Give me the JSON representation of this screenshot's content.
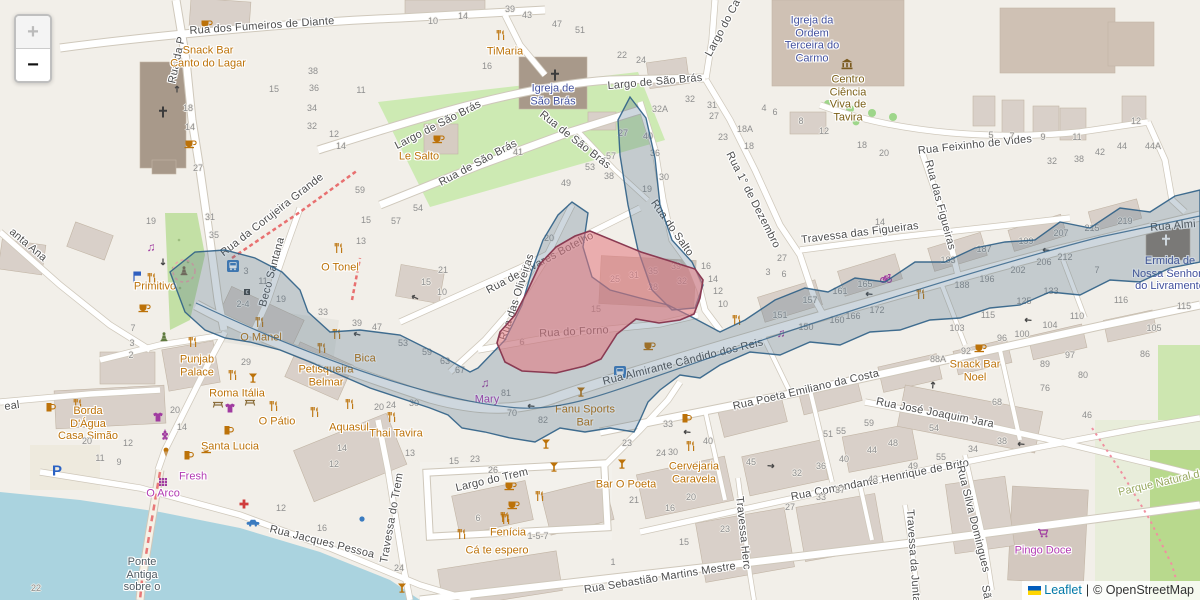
{
  "controls": {
    "zoom_in": "+",
    "zoom_out": "−"
  },
  "attribution": {
    "flag": "ukraine-flag",
    "leaflet": "Leaflet",
    "divider": "|",
    "copyright": "© OpenStreetMap"
  },
  "overlay_colors": {
    "district_fill": "#4a6c84",
    "district_stroke": "#2e5f86",
    "highlight_fill": "#e4777d",
    "highlight_stroke": "#8a3a52"
  },
  "icon_colors": {
    "amenity": "#bc7209",
    "shop": "#a03ba0",
    "transport": "#3a7bc0",
    "tourism": "#7a5a1e",
    "health": "#d03c3c"
  },
  "streets": [
    "Rua dos Fumeiros de Diante",
    "Rua da P",
    "Largo de São Brás",
    "Largo de São Brás",
    "Rua de São Brás",
    "Rua de São Brás",
    "Rua Feixinho de Vides",
    "Largo do Ca",
    "Rua 1° de Dezembro",
    "Rua do Salto",
    "Travessa das Figueiras",
    "Rua das Figueiras",
    "Rua de Álvares Botelho",
    "Rua das Oliveiras",
    "Rua do Forno",
    "Rua Almirante Cândido dos Reis",
    "Rua Almi",
    "Rua da Corujeira Grande",
    "Beco Santana",
    "anta Ana",
    "Rua Poeta Emiliano da Costa",
    "Rua José Joaquim Jara",
    "Rua Comandante Henrique de Brito",
    "Rua Sebastião Martins Mestre",
    "Rua Jacques Pessoa",
    "Largo do Trem",
    "Travessa do Trem",
    "Travessa Herc",
    "Travessa da Junta",
    "Rua Silva Domingues",
    "eal",
    "Sã"
  ],
  "pois": [
    "Snack Bar Canto do Lagar",
    "TiMaria",
    "Igreja de São Brás",
    "Le Salto",
    "Igreja da Ordem Terceira do Carmo",
    "Centro Ciência Viva de Tavira",
    "Ermida de Nossa Senhora do Livramento",
    "O Tonel",
    "Primitivo",
    "O Manel",
    "Punjab Palace",
    "Roma Itália",
    "Petisqueira Belmar",
    "Bica",
    "Mary",
    "Fanu Sports Bar",
    "Borda D'Água Casa Simão",
    "O Pátio",
    "Aquasul",
    "Thai Tavira",
    "Santa Lucia",
    "Fresh",
    "O Arco",
    "Cá te espero",
    "Fenícia",
    "Cervejaria Caravela",
    "Bar O Poeta",
    "Snack Bar Noel",
    "Pingo Doce",
    "Parque Natural da",
    "Ponte Antiga sobre o"
  ],
  "house_numbers": [
    {
      "t": "18",
      "x": 188,
      "y": 108
    },
    {
      "t": "14",
      "x": 190,
      "y": 127
    },
    {
      "t": "27",
      "x": 198,
      "y": 168
    },
    {
      "t": "15",
      "x": 274,
      "y": 89
    },
    {
      "t": "10",
      "x": 433,
      "y": 21
    },
    {
      "t": "14",
      "x": 463,
      "y": 16
    },
    {
      "t": "39",
      "x": 510,
      "y": 9
    },
    {
      "t": "43",
      "x": 527,
      "y": 15
    },
    {
      "t": "47",
      "x": 557,
      "y": 24
    },
    {
      "t": "51",
      "x": 580,
      "y": 30
    },
    {
      "t": "38",
      "x": 313,
      "y": 71
    },
    {
      "t": "36",
      "x": 314,
      "y": 88
    },
    {
      "t": "34",
      "x": 312,
      "y": 108
    },
    {
      "t": "32",
      "x": 312,
      "y": 126
    },
    {
      "t": "12",
      "x": 334,
      "y": 134
    },
    {
      "t": "14",
      "x": 341,
      "y": 146
    },
    {
      "t": "11",
      "x": 361,
      "y": 90
    },
    {
      "t": "16",
      "x": 487,
      "y": 66
    },
    {
      "t": "59",
      "x": 360,
      "y": 190
    },
    {
      "t": "41",
      "x": 518,
      "y": 152
    },
    {
      "t": "53",
      "x": 590,
      "y": 167
    },
    {
      "t": "49",
      "x": 566,
      "y": 183
    },
    {
      "t": "22",
      "x": 622,
      "y": 55
    },
    {
      "t": "24",
      "x": 641,
      "y": 60
    },
    {
      "t": "32",
      "x": 690,
      "y": 99
    },
    {
      "t": "32A",
      "x": 660,
      "y": 109
    },
    {
      "t": "31",
      "x": 712,
      "y": 105
    },
    {
      "t": "27",
      "x": 714,
      "y": 116
    },
    {
      "t": "18A",
      "x": 745,
      "y": 129
    },
    {
      "t": "23",
      "x": 723,
      "y": 137
    },
    {
      "t": "18",
      "x": 749,
      "y": 146
    },
    {
      "t": "4",
      "x": 764,
      "y": 108
    },
    {
      "t": "6",
      "x": 775,
      "y": 112
    },
    {
      "t": "8",
      "x": 801,
      "y": 121
    },
    {
      "t": "12",
      "x": 824,
      "y": 131
    },
    {
      "t": "18",
      "x": 862,
      "y": 145
    },
    {
      "t": "20",
      "x": 884,
      "y": 153
    },
    {
      "t": "27",
      "x": 623,
      "y": 133
    },
    {
      "t": "40",
      "x": 648,
      "y": 136
    },
    {
      "t": "57",
      "x": 611,
      "y": 156
    },
    {
      "t": "36",
      "x": 655,
      "y": 153
    },
    {
      "t": "38",
      "x": 609,
      "y": 176
    },
    {
      "t": "30",
      "x": 664,
      "y": 177
    },
    {
      "t": "19",
      "x": 647,
      "y": 189
    },
    {
      "t": "5",
      "x": 991,
      "y": 135
    },
    {
      "t": "7",
      "x": 1012,
      "y": 136
    },
    {
      "t": "9",
      "x": 1043,
      "y": 137
    },
    {
      "t": "11",
      "x": 1077,
      "y": 137
    },
    {
      "t": "12",
      "x": 1136,
      "y": 121
    },
    {
      "t": "44",
      "x": 1122,
      "y": 146
    },
    {
      "t": "44A",
      "x": 1153,
      "y": 146
    },
    {
      "t": "42",
      "x": 1100,
      "y": 152
    },
    {
      "t": "38",
      "x": 1079,
      "y": 159
    },
    {
      "t": "32",
      "x": 1052,
      "y": 161
    },
    {
      "t": "19",
      "x": 151,
      "y": 221
    },
    {
      "t": "31",
      "x": 210,
      "y": 217
    },
    {
      "t": "35",
      "x": 214,
      "y": 235
    },
    {
      "t": "3",
      "x": 246,
      "y": 271
    },
    {
      "t": "11",
      "x": 263,
      "y": 281
    },
    {
      "t": "19",
      "x": 281,
      "y": 299
    },
    {
      "t": "2-4",
      "x": 243,
      "y": 304
    },
    {
      "t": "29",
      "x": 246,
      "y": 362
    },
    {
      "t": "22",
      "x": 36,
      "y": 588
    },
    {
      "t": "7",
      "x": 133,
      "y": 328
    },
    {
      "t": "3",
      "x": 132,
      "y": 343
    },
    {
      "t": "2",
      "x": 131,
      "y": 355
    },
    {
      "t": "54",
      "x": 418,
      "y": 208
    },
    {
      "t": "57",
      "x": 396,
      "y": 221
    },
    {
      "t": "15",
      "x": 366,
      "y": 220
    },
    {
      "t": "13",
      "x": 361,
      "y": 241
    },
    {
      "t": "21",
      "x": 443,
      "y": 270
    },
    {
      "t": "15",
      "x": 426,
      "y": 282
    },
    {
      "t": "10",
      "x": 442,
      "y": 292
    },
    {
      "t": "33",
      "x": 323,
      "y": 312
    },
    {
      "t": "39",
      "x": 357,
      "y": 323
    },
    {
      "t": "47",
      "x": 377,
      "y": 327
    },
    {
      "t": "53",
      "x": 403,
      "y": 343
    },
    {
      "t": "59",
      "x": 427,
      "y": 352
    },
    {
      "t": "63",
      "x": 445,
      "y": 361
    },
    {
      "t": "67",
      "x": 460,
      "y": 370
    },
    {
      "t": "81",
      "x": 506,
      "y": 393
    },
    {
      "t": "70",
      "x": 512,
      "y": 413
    },
    {
      "t": "82",
      "x": 543,
      "y": 420
    },
    {
      "t": "25",
      "x": 615,
      "y": 279
    },
    {
      "t": "31",
      "x": 634,
      "y": 275
    },
    {
      "t": "35",
      "x": 653,
      "y": 271
    },
    {
      "t": "39",
      "x": 676,
      "y": 266
    },
    {
      "t": "28",
      "x": 653,
      "y": 287
    },
    {
      "t": "32",
      "x": 682,
      "y": 281
    },
    {
      "t": "15",
      "x": 596,
      "y": 309
    },
    {
      "t": "6",
      "x": 522,
      "y": 342
    },
    {
      "t": "20",
      "x": 549,
      "y": 238
    },
    {
      "t": "16",
      "x": 706,
      "y": 266
    },
    {
      "t": "14",
      "x": 713,
      "y": 279
    },
    {
      "t": "12",
      "x": 718,
      "y": 291
    },
    {
      "t": "10",
      "x": 723,
      "y": 304
    },
    {
      "t": "27",
      "x": 782,
      "y": 258
    },
    {
      "t": "3",
      "x": 768,
      "y": 272
    },
    {
      "t": "6",
      "x": 784,
      "y": 274
    },
    {
      "t": "14",
      "x": 880,
      "y": 222
    },
    {
      "t": "151",
      "x": 780,
      "y": 315
    },
    {
      "t": "157",
      "x": 810,
      "y": 300
    },
    {
      "t": "161",
      "x": 840,
      "y": 291
    },
    {
      "t": "165",
      "x": 865,
      "y": 284
    },
    {
      "t": "150",
      "x": 806,
      "y": 327
    },
    {
      "t": "160",
      "x": 837,
      "y": 320
    },
    {
      "t": "166",
      "x": 853,
      "y": 316
    },
    {
      "t": "172",
      "x": 877,
      "y": 310
    },
    {
      "t": "187",
      "x": 984,
      "y": 249
    },
    {
      "t": "199",
      "x": 1026,
      "y": 241
    },
    {
      "t": "207",
      "x": 1061,
      "y": 233
    },
    {
      "t": "215",
      "x": 1092,
      "y": 228
    },
    {
      "t": "219",
      "x": 1125,
      "y": 221
    },
    {
      "t": "183",
      "x": 948,
      "y": 260
    },
    {
      "t": "202",
      "x": 1018,
      "y": 270
    },
    {
      "t": "206",
      "x": 1044,
      "y": 262
    },
    {
      "t": "212",
      "x": 1065,
      "y": 257
    },
    {
      "t": "196",
      "x": 987,
      "y": 279
    },
    {
      "t": "188",
      "x": 962,
      "y": 285
    },
    {
      "t": "133",
      "x": 1051,
      "y": 291
    },
    {
      "t": "125",
      "x": 1024,
      "y": 301
    },
    {
      "t": "115",
      "x": 988,
      "y": 315
    },
    {
      "t": "103",
      "x": 957,
      "y": 328
    },
    {
      "t": "96",
      "x": 1002,
      "y": 338
    },
    {
      "t": "100",
      "x": 1022,
      "y": 334
    },
    {
      "t": "104",
      "x": 1050,
      "y": 325
    },
    {
      "t": "110",
      "x": 1077,
      "y": 316
    },
    {
      "t": "92",
      "x": 966,
      "y": 351
    },
    {
      "t": "88A",
      "x": 938,
      "y": 359
    },
    {
      "t": "89",
      "x": 1045,
      "y": 364
    },
    {
      "t": "97",
      "x": 1070,
      "y": 355
    },
    {
      "t": "80",
      "x": 1083,
      "y": 375
    },
    {
      "t": "76",
      "x": 1045,
      "y": 388
    },
    {
      "t": "105",
      "x": 1154,
      "y": 328
    },
    {
      "t": "115",
      "x": 1184,
      "y": 306
    },
    {
      "t": "116",
      "x": 1121,
      "y": 300
    },
    {
      "t": "86",
      "x": 1145,
      "y": 354
    },
    {
      "t": "7",
      "x": 1097,
      "y": 270
    },
    {
      "t": "20",
      "x": 175,
      "y": 410
    },
    {
      "t": "14",
      "x": 182,
      "y": 427
    },
    {
      "t": "12",
      "x": 128,
      "y": 443
    },
    {
      "t": "20",
      "x": 87,
      "y": 441
    },
    {
      "t": "11",
      "x": 100,
      "y": 458
    },
    {
      "t": "9",
      "x": 119,
      "y": 462
    },
    {
      "t": "12",
      "x": 281,
      "y": 508
    },
    {
      "t": "20",
      "x": 379,
      "y": 407
    },
    {
      "t": "24",
      "x": 391,
      "y": 405
    },
    {
      "t": "30",
      "x": 414,
      "y": 403
    },
    {
      "t": "14",
      "x": 342,
      "y": 448
    },
    {
      "t": "12",
      "x": 334,
      "y": 464
    },
    {
      "t": "13",
      "x": 410,
      "y": 453
    },
    {
      "t": "15",
      "x": 454,
      "y": 461
    },
    {
      "t": "23",
      "x": 475,
      "y": 459
    },
    {
      "t": "26",
      "x": 493,
      "y": 470
    },
    {
      "t": "16",
      "x": 322,
      "y": 528
    },
    {
      "t": "6",
      "x": 478,
      "y": 518
    },
    {
      "t": "24",
      "x": 399,
      "y": 568
    },
    {
      "t": "1-5-7",
      "x": 538,
      "y": 536
    },
    {
      "t": "33",
      "x": 668,
      "y": 424
    },
    {
      "t": "23",
      "x": 627,
      "y": 443
    },
    {
      "t": "24",
      "x": 661,
      "y": 453
    },
    {
      "t": "30",
      "x": 673,
      "y": 452
    },
    {
      "t": "40",
      "x": 708,
      "y": 441
    },
    {
      "t": "45",
      "x": 751,
      "y": 462
    },
    {
      "t": "51",
      "x": 828,
      "y": 434
    },
    {
      "t": "55",
      "x": 841,
      "y": 431
    },
    {
      "t": "59",
      "x": 869,
      "y": 423
    },
    {
      "t": "44",
      "x": 872,
      "y": 450
    },
    {
      "t": "48",
      "x": 893,
      "y": 443
    },
    {
      "t": "40",
      "x": 844,
      "y": 459
    },
    {
      "t": "36",
      "x": 821,
      "y": 466
    },
    {
      "t": "32",
      "x": 797,
      "y": 473
    },
    {
      "t": "27",
      "x": 790,
      "y": 507
    },
    {
      "t": "33",
      "x": 821,
      "y": 497
    },
    {
      "t": "37",
      "x": 840,
      "y": 490
    },
    {
      "t": "43",
      "x": 873,
      "y": 479
    },
    {
      "t": "21",
      "x": 634,
      "y": 500
    },
    {
      "t": "20",
      "x": 691,
      "y": 497
    },
    {
      "t": "16",
      "x": 670,
      "y": 508
    },
    {
      "t": "23",
      "x": 725,
      "y": 529
    },
    {
      "t": "15",
      "x": 684,
      "y": 542
    },
    {
      "t": "1",
      "x": 613,
      "y": 562
    },
    {
      "t": "68",
      "x": 997,
      "y": 402
    },
    {
      "t": "46",
      "x": 1087,
      "y": 415
    },
    {
      "t": "54",
      "x": 934,
      "y": 428
    },
    {
      "t": "38",
      "x": 1002,
      "y": 441
    },
    {
      "t": "34",
      "x": 973,
      "y": 449
    },
    {
      "t": "55",
      "x": 941,
      "y": 457
    },
    {
      "t": "49",
      "x": 913,
      "y": 466
    }
  ],
  "icons": [
    {
      "type": "cafe",
      "x": 206,
      "y": 24
    },
    {
      "type": "cafe",
      "x": 190,
      "y": 144
    },
    {
      "type": "cafe",
      "x": 144,
      "y": 308
    },
    {
      "type": "cafe",
      "x": 438,
      "y": 139
    },
    {
      "type": "cafe",
      "x": 649,
      "y": 346
    },
    {
      "type": "cafe",
      "x": 980,
      "y": 348
    },
    {
      "type": "cafe",
      "x": 510,
      "y": 486
    },
    {
      "type": "cafe",
      "x": 513,
      "y": 505
    },
    {
      "type": "cafe",
      "x": 207,
      "y": 449
    },
    {
      "type": "restaurant",
      "x": 501,
      "y": 35
    },
    {
      "type": "restaurant",
      "x": 152,
      "y": 278
    },
    {
      "type": "restaurant",
      "x": 339,
      "y": 248
    },
    {
      "type": "restaurant",
      "x": 260,
      "y": 322
    },
    {
      "type": "restaurant",
      "x": 193,
      "y": 342
    },
    {
      "type": "restaurant",
      "x": 233,
      "y": 375
    },
    {
      "type": "restaurant",
      "x": 322,
      "y": 348
    },
    {
      "type": "restaurant",
      "x": 337,
      "y": 334
    },
    {
      "type": "restaurant",
      "x": 350,
      "y": 404
    },
    {
      "type": "restaurant",
      "x": 737,
      "y": 320
    },
    {
      "type": "restaurant",
      "x": 315,
      "y": 412
    },
    {
      "type": "restaurant",
      "x": 392,
      "y": 417
    },
    {
      "type": "restaurant",
      "x": 274,
      "y": 406
    },
    {
      "type": "restaurant",
      "x": 78,
      "y": 404
    },
    {
      "type": "restaurant",
      "x": 540,
      "y": 496
    },
    {
      "type": "restaurant",
      "x": 505,
      "y": 517
    },
    {
      "type": "restaurant",
      "x": 462,
      "y": 534
    },
    {
      "type": "restaurant",
      "x": 506,
      "y": 519
    },
    {
      "type": "restaurant",
      "x": 691,
      "y": 446
    },
    {
      "type": "restaurant",
      "x": 921,
      "y": 294
    },
    {
      "type": "bar",
      "x": 554,
      "y": 467
    },
    {
      "type": "bar",
      "x": 546,
      "y": 444
    },
    {
      "type": "bar",
      "x": 622,
      "y": 464
    },
    {
      "type": "bar",
      "x": 253,
      "y": 378
    },
    {
      "type": "bar",
      "x": 581,
      "y": 392
    },
    {
      "type": "bar",
      "x": 402,
      "y": 588
    },
    {
      "type": "pub",
      "x": 188,
      "y": 455
    },
    {
      "type": "pub",
      "x": 686,
      "y": 418
    },
    {
      "type": "pub",
      "x": 228,
      "y": 430
    },
    {
      "type": "pub",
      "x": 50,
      "y": 407
    },
    {
      "type": "music",
      "x": 485,
      "y": 383,
      "c": "#a03ba0"
    },
    {
      "type": "music",
      "x": 781,
      "y": 333,
      "c": "#a03ba0"
    },
    {
      "type": "music",
      "x": 151,
      "y": 247,
      "c": "#a03ba0"
    },
    {
      "type": "shirt",
      "x": 158,
      "y": 417,
      "c": "#a03ba0"
    },
    {
      "type": "shirt",
      "x": 230,
      "y": 408,
      "c": "#a03ba0"
    },
    {
      "type": "grid",
      "x": 163,
      "y": 482,
      "c": "#a03ba0"
    },
    {
      "type": "grapes",
      "x": 165,
      "y": 435,
      "c": "#a03ba0"
    },
    {
      "type": "icecream",
      "x": 166,
      "y": 452
    },
    {
      "type": "cart",
      "x": 1043,
      "y": 533,
      "c": "#a03ba0"
    },
    {
      "type": "cross",
      "x": 163,
      "y": 112,
      "c": "#3c3c3c"
    },
    {
      "type": "cross",
      "x": 555,
      "y": 75,
      "c": "#3c3c3c"
    },
    {
      "type": "cross",
      "x": 1166,
      "y": 240,
      "c": "#ffffff"
    },
    {
      "type": "museum",
      "x": 847,
      "y": 64,
      "c": "#7a5a1e"
    },
    {
      "type": "bus",
      "x": 233,
      "y": 266,
      "c": "#3a7bc0"
    },
    {
      "type": "bus",
      "x": 620,
      "y": 372,
      "c": "#3a7bc0"
    },
    {
      "type": "flag",
      "x": 137,
      "y": 277,
      "c": "#2f5fbf"
    },
    {
      "type": "statue",
      "x": 184,
      "y": 271,
      "c": "#7d6a4f"
    },
    {
      "type": "statue",
      "x": 164,
      "y": 337,
      "c": "#5f7a3f"
    },
    {
      "type": "bike",
      "x": 886,
      "y": 278,
      "c": "#a03ba0"
    },
    {
      "type": "picnic",
      "x": 218,
      "y": 404,
      "c": "#8a6d3b"
    },
    {
      "type": "picnic",
      "x": 250,
      "y": 402,
      "c": "#8a6d3b"
    },
    {
      "type": "dot",
      "x": 362,
      "y": 519,
      "c": "#3a7bc0"
    },
    {
      "type": "taxi",
      "x": 253,
      "y": 523,
      "c": "#3a7bc0"
    },
    {
      "type": "parking",
      "x": 57,
      "y": 470,
      "c": "#2a62c4"
    },
    {
      "type": "pharmacy",
      "x": 244,
      "y": 504,
      "c": "#d03c3c"
    },
    {
      "type": "atm",
      "x": 247,
      "y": 292,
      "c": "#444444"
    },
    {
      "type": "arrow",
      "x": 177,
      "y": 88,
      "c": "#4a4a4a",
      "r": -90
    },
    {
      "type": "arrow",
      "x": 414,
      "y": 297,
      "c": "#4a4a4a",
      "r": 205
    },
    {
      "type": "arrow",
      "x": 356,
      "y": 334,
      "c": "#4a4a4a",
      "r": 195
    },
    {
      "type": "arrow",
      "x": 868,
      "y": 294,
      "c": "#4a4a4a",
      "r": 185
    },
    {
      "type": "arrow",
      "x": 1045,
      "y": 250,
      "c": "#4a4a4a",
      "r": 185
    },
    {
      "type": "arrow",
      "x": 1027,
      "y": 320,
      "c": "#4a4a4a",
      "r": 185
    },
    {
      "type": "arrow",
      "x": 772,
      "y": 466,
      "c": "#4a4a4a",
      "r": 5
    },
    {
      "type": "arrow",
      "x": 686,
      "y": 432,
      "c": "#4a4a4a",
      "r": 185
    },
    {
      "type": "arrow",
      "x": 530,
      "y": 406,
      "c": "#4a4a4a",
      "r": 185
    },
    {
      "type": "arrow",
      "x": 933,
      "y": 384,
      "c": "#4a4a4a",
      "r": -85
    },
    {
      "type": "arrow",
      "x": 1020,
      "y": 444,
      "c": "#4a4a4a",
      "r": 185
    },
    {
      "type": "arrow",
      "x": 163,
      "y": 263,
      "c": "#4a4a4a",
      "r": 90
    }
  ]
}
